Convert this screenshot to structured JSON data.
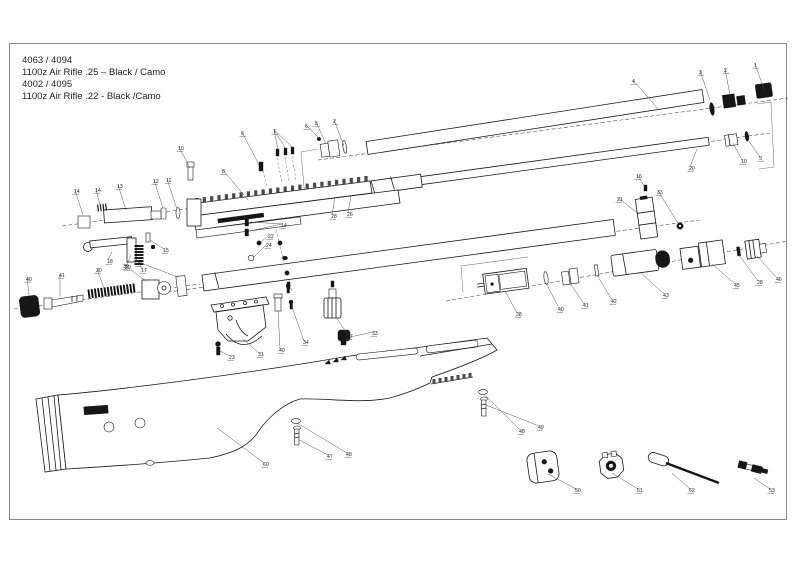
{
  "title_block": {
    "lines": [
      "4063 / 4094",
      "1100z Air Rifle .25 – Black / Camo",
      "4002 / 4095",
      "1100z Air Rifle .22 - Black /Camo"
    ]
  },
  "colors": {
    "ink": "#1a1a1a",
    "label": "#222222",
    "background": "#ffffff",
    "border": "#888888"
  },
  "callouts": [
    {
      "n": "4",
      "x": 632,
      "y": 83,
      "leaders": [
        [
          658,
          109
        ]
      ]
    },
    {
      "n": "3",
      "x": 699,
      "y": 74,
      "leaders": [
        [
          710,
          100
        ]
      ]
    },
    {
      "n": "2",
      "x": 724,
      "y": 72,
      "leaders": [
        [
          730,
          95
        ]
      ]
    },
    {
      "n": "1",
      "x": 754,
      "y": 67,
      "leaders": [
        [
          764,
          89
        ]
      ]
    },
    {
      "n": "6",
      "x": 305,
      "y": 128,
      "leaders": [
        [
          318,
          137
        ]
      ]
    },
    {
      "n": "5",
      "x": 315,
      "y": 125,
      "leaders": [
        [
          326,
          144
        ]
      ]
    },
    {
      "n": "2",
      "x": 333,
      "y": 123,
      "leaders": [
        [
          344,
          146
        ]
      ]
    },
    {
      "n": "20",
      "x": 689,
      "y": 170,
      "leaders": [
        [
          697,
          149
        ]
      ]
    },
    {
      "n": "10",
      "x": 741,
      "y": 163,
      "leaders": [
        [
          733,
          143
        ]
      ]
    },
    {
      "n": "9",
      "x": 759,
      "y": 160,
      "leaders": [
        [
          748,
          140
        ]
      ]
    },
    {
      "n": "26",
      "x": 347,
      "y": 216,
      "leaders": [
        [
          351,
          196
        ]
      ]
    },
    {
      "n": "28",
      "x": 331,
      "y": 218,
      "leaders": [
        [
          335,
          197
        ]
      ]
    },
    {
      "n": "8",
      "x": 222,
      "y": 173,
      "leaders": [
        [
          248,
          200
        ]
      ]
    },
    {
      "n": "10",
      "x": 178,
      "y": 150,
      "leaders": [
        [
          190,
          168
        ]
      ]
    },
    {
      "n": "6",
      "x": 241,
      "y": 135,
      "leaders": [
        [
          259,
          165
        ]
      ]
    },
    {
      "n": "7",
      "x": 273,
      "y": 133,
      "leaders": [
        [
          278,
          150
        ],
        [
          286,
          149
        ],
        [
          293,
          148
        ]
      ]
    },
    {
      "n": "14",
      "x": 74,
      "y": 193,
      "leaders": [
        [
          83,
          215
        ]
      ]
    },
    {
      "n": "14",
      "x": 95,
      "y": 192,
      "leaders": [
        [
          101,
          209
        ]
      ]
    },
    {
      "n": "13",
      "x": 117,
      "y": 188,
      "leaders": [
        [
          126,
          210
        ]
      ]
    },
    {
      "n": "12",
      "x": 153,
      "y": 183,
      "leaders": [
        [
          163,
          208
        ]
      ]
    },
    {
      "n": "11",
      "x": 166,
      "y": 182,
      "leaders": [
        [
          177,
          209
        ]
      ]
    },
    {
      "n": "18",
      "x": 107,
      "y": 263,
      "leaders": [
        [
          112,
          252
        ]
      ]
    },
    {
      "n": "17",
      "x": 141,
      "y": 272,
      "leaders": [
        [
          139,
          263
        ]
      ]
    },
    {
      "n": "29",
      "x": 125,
      "y": 269,
      "leaders": [
        [
          131,
          255
        ]
      ]
    },
    {
      "n": "15",
      "x": 163,
      "y": 252,
      "leaders": [
        [
          150,
          240
        ]
      ]
    },
    {
      "n": "40",
      "x": 26,
      "y": 281,
      "leaders": [
        [
          29,
          295
        ]
      ]
    },
    {
      "n": "41",
      "x": 59,
      "y": 277,
      "leaders": [
        [
          60,
          296
        ]
      ]
    },
    {
      "n": "30",
      "x": 96,
      "y": 272,
      "leaders": [
        [
          104,
          288
        ]
      ]
    },
    {
      "n": "32",
      "x": 123,
      "y": 268,
      "leaders": [
        [
          146,
          281
        ]
      ]
    },
    {
      "n": "33",
      "x": 137,
      "y": 265,
      "leaders": [
        [
          178,
          277
        ]
      ]
    },
    {
      "n": "16",
      "x": 636,
      "y": 178,
      "leaders": [
        [
          645,
          187
        ]
      ]
    },
    {
      "n": "21",
      "x": 617,
      "y": 201,
      "leaders": [
        [
          639,
          214
        ]
      ]
    },
    {
      "n": "33",
      "x": 657,
      "y": 194,
      "leaders": [
        [
          678,
          223
        ]
      ]
    },
    {
      "n": "14",
      "x": 281,
      "y": 227,
      "leaders": [
        [
          250,
          222
        ],
        [
          250,
          231
        ]
      ]
    },
    {
      "n": "22",
      "x": 268,
      "y": 238,
      "leaders": [
        [
          261,
          242
        ]
      ]
    },
    {
      "n": "24",
      "x": 266,
      "y": 247,
      "leaders": [
        [
          254,
          257
        ]
      ]
    },
    {
      "n": "23",
      "x": 229,
      "y": 359,
      "leaders": [
        [
          220,
          351
        ]
      ]
    },
    {
      "n": "31",
      "x": 258,
      "y": 356,
      "leaders": [
        [
          242,
          338
        ]
      ]
    },
    {
      "n": "40",
      "x": 279,
      "y": 352,
      "leaders": [
        [
          278,
          310
        ]
      ]
    },
    {
      "n": "34",
      "x": 303,
      "y": 344,
      "leaders": [
        [
          292,
          307
        ]
      ]
    },
    {
      "n": "37",
      "x": 347,
      "y": 338,
      "leaders": [
        [
          336,
          317
        ]
      ]
    },
    {
      "n": "33",
      "x": 372,
      "y": 335,
      "leaders": [
        [
          350,
          337
        ]
      ]
    },
    {
      "n": "38",
      "x": 516,
      "y": 316,
      "leaders": [
        [
          505,
          291
        ]
      ]
    },
    {
      "n": "40",
      "x": 558,
      "y": 311,
      "leaders": [
        [
          546,
          283
        ]
      ]
    },
    {
      "n": "41",
      "x": 583,
      "y": 307,
      "leaders": [
        [
          570,
          283
        ]
      ]
    },
    {
      "n": "42",
      "x": 611,
      "y": 303,
      "leaders": [
        [
          597,
          275
        ]
      ]
    },
    {
      "n": "43",
      "x": 663,
      "y": 297,
      "leaders": [
        [
          640,
          272
        ]
      ]
    },
    {
      "n": "45",
      "x": 734,
      "y": 287,
      "leaders": [
        [
          712,
          264
        ]
      ]
    },
    {
      "n": "28",
      "x": 757,
      "y": 284,
      "leaders": [
        [
          739,
          255
        ]
      ]
    },
    {
      "n": "46",
      "x": 776,
      "y": 281,
      "leaders": [
        [
          757,
          256
        ]
      ]
    },
    {
      "n": "60",
      "x": 263,
      "y": 466,
      "leaders": [
        [
          217,
          428
        ]
      ]
    },
    {
      "n": "47",
      "x": 327,
      "y": 458,
      "leaders": [
        [
          299,
          440
        ]
      ]
    },
    {
      "n": "48",
      "x": 346,
      "y": 456,
      "leaders": [
        [
          297,
          423
        ]
      ]
    },
    {
      "n": "48",
      "x": 519,
      "y": 433,
      "leaders": [
        [
          484,
          394
        ]
      ]
    },
    {
      "n": "49",
      "x": 538,
      "y": 429,
      "leaders": [
        [
          486,
          405
        ]
      ]
    },
    {
      "n": "50",
      "x": 575,
      "y": 492,
      "leaders": [
        [
          548,
          474
        ]
      ]
    },
    {
      "n": "51",
      "x": 637,
      "y": 492,
      "leaders": [
        [
          612,
          473
        ]
      ]
    },
    {
      "n": "52",
      "x": 689,
      "y": 492,
      "leaders": [
        [
          672,
          473
        ]
      ]
    },
    {
      "n": "53",
      "x": 769,
      "y": 492,
      "leaders": [
        [
          754,
          478
        ]
      ]
    }
  ]
}
